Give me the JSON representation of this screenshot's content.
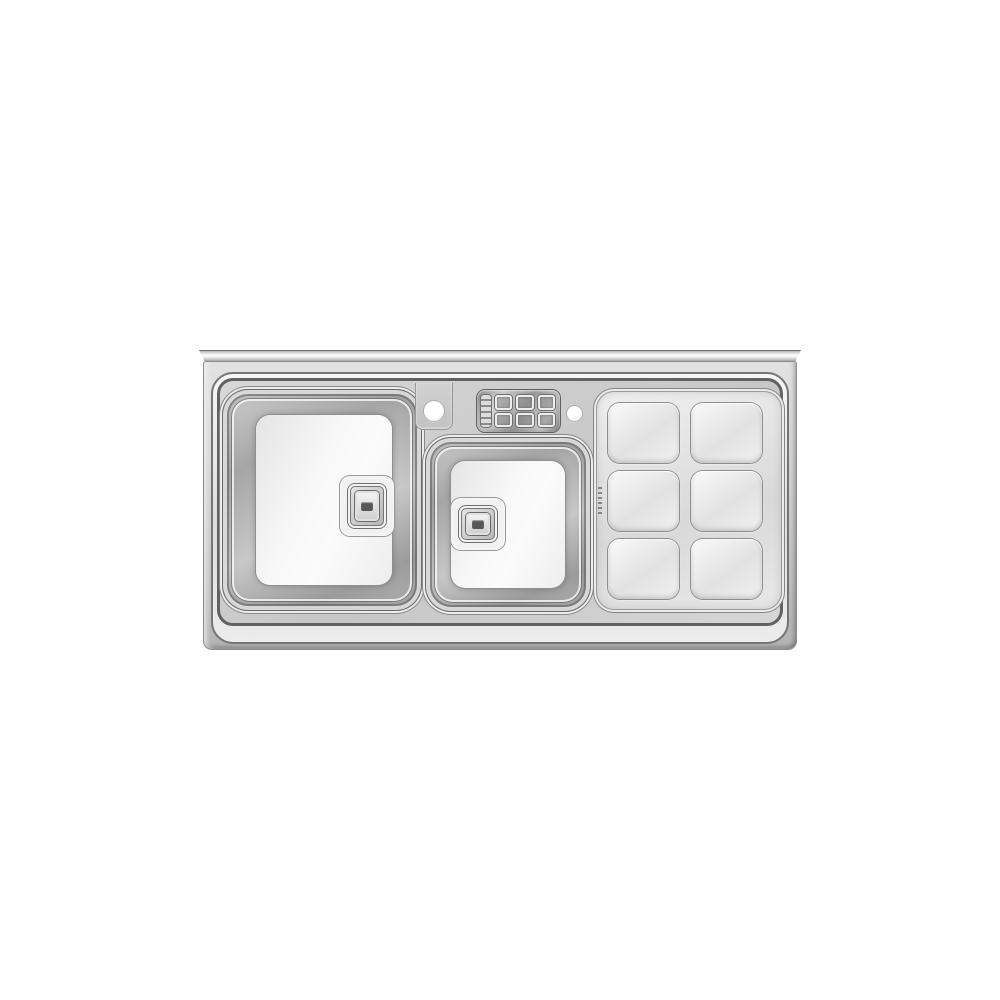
{
  "scene": {
    "type": "product-photograph",
    "subject": "Top-mount stainless steel kitchen sink with two square bowls and a ribbed drainboard, front view on white background",
    "background_color": "#ffffff"
  },
  "sink": {
    "finish": "polished stainless steel",
    "colors": {
      "background": "#ffffff",
      "steel_bright": "#f6f6f6",
      "steel_light": "#e2e2e2",
      "steel_mid": "#c9c9c9",
      "steel_shadow": "#9a9a9a",
      "steel_dark": "#6a6a6a",
      "line_dark": "#565656",
      "bowl_floor": "#fbfbfb"
    },
    "deck": {
      "faucet_hole_count": 2,
      "accessory_tray": {
        "slot_rows": 2,
        "slot_columns": 3,
        "slots": 6
      }
    },
    "bowls": {
      "count": 2,
      "items": [
        {
          "name": "left-bowl",
          "size": "large",
          "shape": "rounded-square",
          "drain": "square center drain"
        },
        {
          "name": "middle-bowl",
          "size": "medium",
          "shape": "rounded-square",
          "drain": "square center drain"
        }
      ]
    },
    "drainboard": {
      "position": "right",
      "rows": 3,
      "columns": 2,
      "cells": 6,
      "cell_shape": "rounded-square",
      "brand_mark": "small engraved mark (illegible)"
    }
  }
}
